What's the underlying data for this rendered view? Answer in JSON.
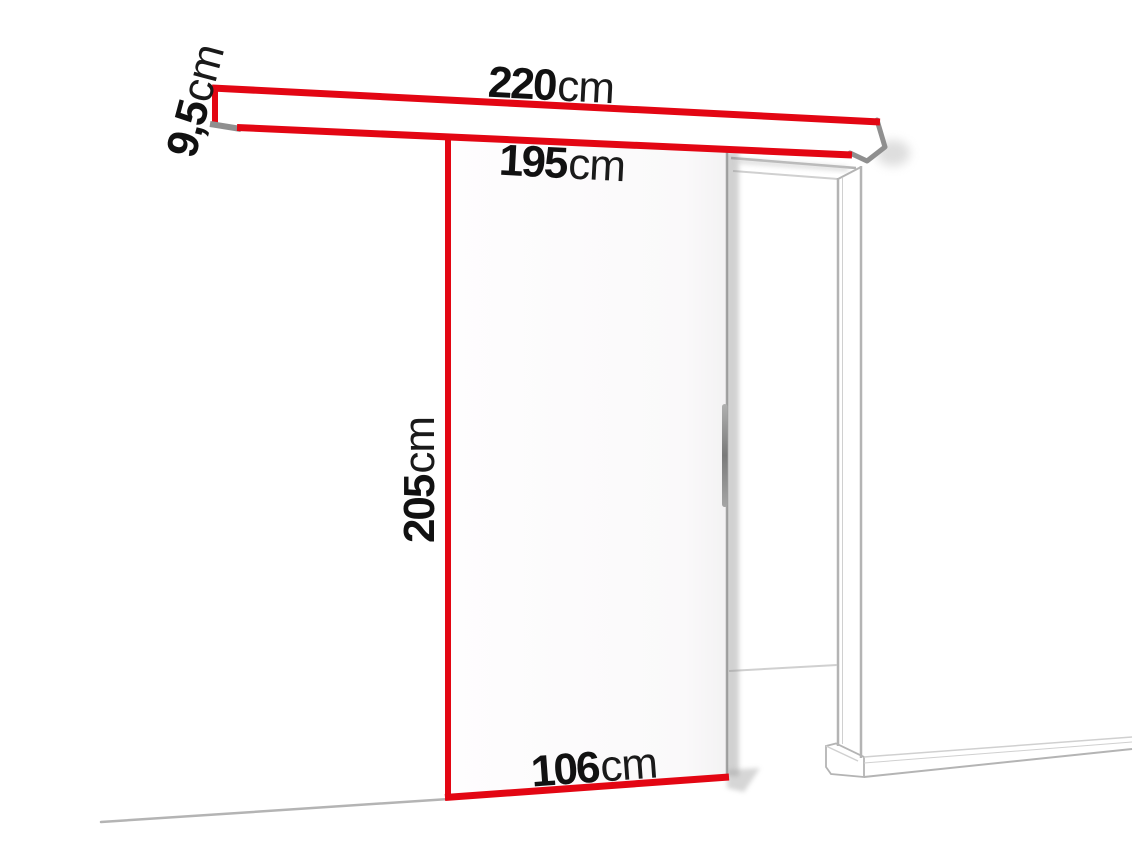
{
  "diagram": {
    "name": "sliding-door-system-dimension-diagram",
    "colors": {
      "accent": "#e30613",
      "line": "#b4b4b4",
      "dark_line": "#8f8f8f",
      "text": "#111111",
      "background": "#ffffff"
    },
    "labels": {
      "rail_width": {
        "value": "220",
        "unit": "cm"
      },
      "rail_height": {
        "value": "9,5",
        "unit": "cm"
      },
      "clearance_width": {
        "value": "195",
        "unit": "cm"
      },
      "door_height": {
        "value": "205",
        "unit": "cm"
      },
      "door_width": {
        "value": "106",
        "unit": "cm"
      }
    }
  }
}
